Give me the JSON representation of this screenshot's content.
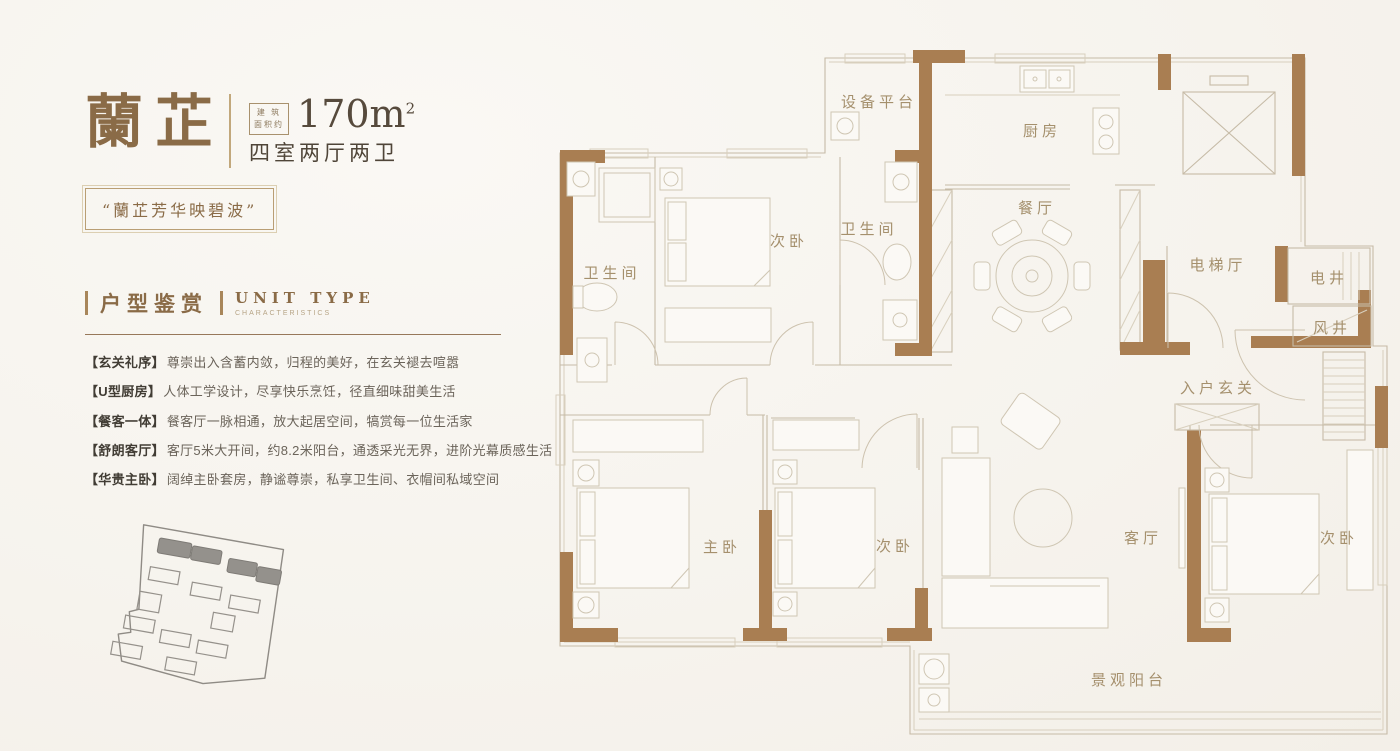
{
  "header": {
    "title": "蘭芷",
    "area_badge_line1": "建 筑",
    "area_badge_line2": "面积约",
    "area_value": "170m",
    "area_unit_sup": "2",
    "layout_type": "四室两厅两卫",
    "tagline": "“蘭芷芳华映碧波”"
  },
  "section": {
    "title_cn": "户型鉴赏",
    "title_en": "UNIT TYPE",
    "subtitle_en": "CHARACTERISTICS"
  },
  "features": [
    {
      "tag": "【玄关礼序】",
      "desc": "尊崇出入含蓄内敛，归程的美好，在玄关褪去喧嚣"
    },
    {
      "tag": "【U型厨房】",
      "desc": "人体工学设计，尽享快乐烹饪，径直细味甜美生活"
    },
    {
      "tag": "【餐客一体】",
      "desc": "餐客厅一脉相通，放大起居空间，犒赏每一位生活家"
    },
    {
      "tag": "【舒朗客厅】",
      "desc": "客厅5米大开间，约8.2米阳台，通透采光无界，进阶光幕质感生活"
    },
    {
      "tag": "【华贵主卧】",
      "desc": "阔绰主卧套房，静谧尊崇，私享卫生间、衣帽间私域空间"
    }
  ],
  "floorplan": {
    "rooms": {
      "equipment_platform": "设备平台",
      "kitchen": "厨房",
      "dining": "餐厅",
      "elevator_hall": "电梯厅",
      "electric_shaft": "电井",
      "wind_shaft": "风井",
      "bathroom_1": "卫生间",
      "bedroom_top": "次卧",
      "bathroom_2": "卫生间",
      "entry": "入户玄关",
      "master_bedroom": "主卧",
      "bedroom_mid": "次卧",
      "living": "客厅",
      "bedroom_right": "次卧",
      "balcony": "景观阳台"
    }
  },
  "colors": {
    "wall_brown": "#a97e52",
    "plan_line": "#c6bba7",
    "accent_brown": "#8a6b47",
    "text_dark": "#554839",
    "text_body": "#6b645a"
  }
}
